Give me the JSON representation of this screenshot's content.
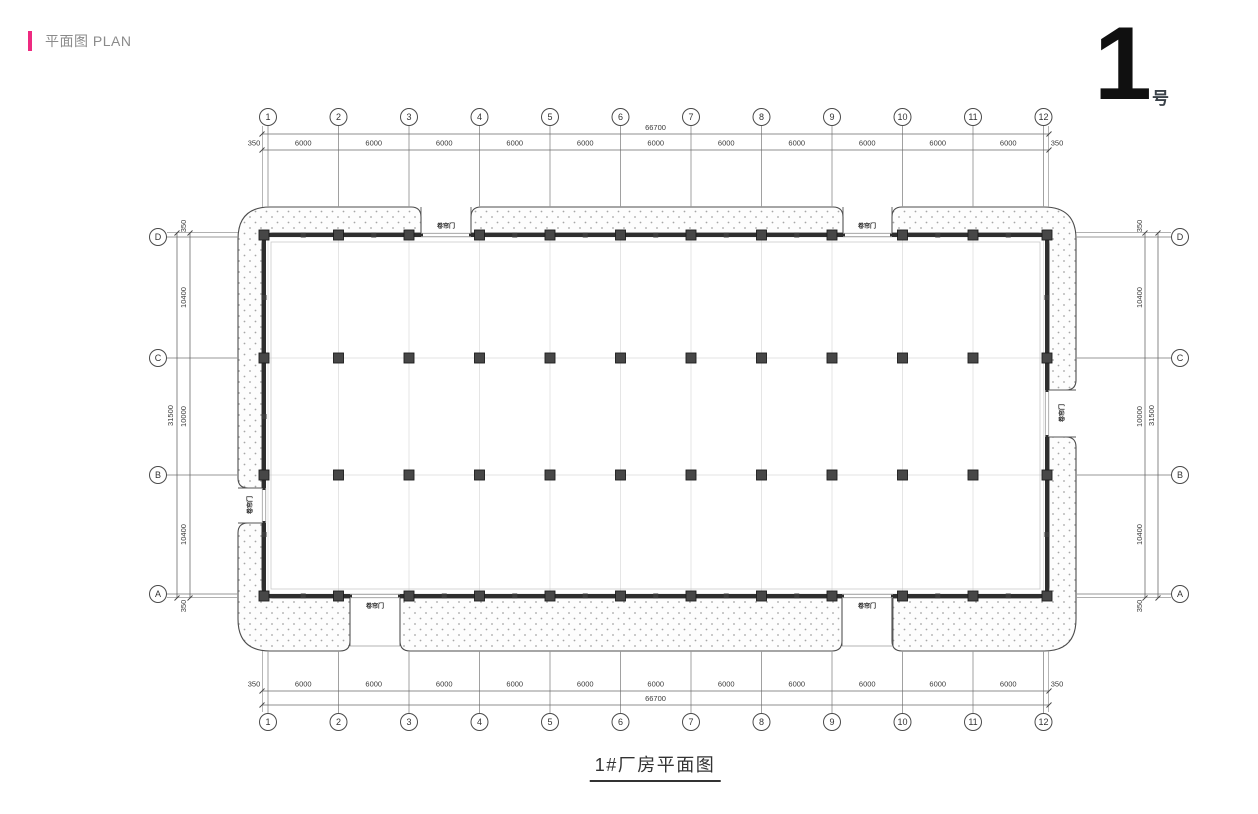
{
  "header": {
    "title": "平面图 PLAN",
    "accent_color": "#ee2a80"
  },
  "sheet_badge": {
    "number": "1",
    "suffix": "号"
  },
  "drawing": {
    "title": "1#厂房平面图",
    "axes": {
      "columns": [
        "1",
        "2",
        "3",
        "4",
        "5",
        "6",
        "7",
        "8",
        "9",
        "10",
        "11",
        "12"
      ],
      "rows_top_to_bottom": [
        "D",
        "C",
        "B",
        "A"
      ]
    },
    "dimensions": {
      "horizontal": {
        "total": "66700",
        "segments": [
          "350",
          "6000",
          "6000",
          "6000",
          "6000",
          "6000",
          "6000",
          "6000",
          "6000",
          "6000",
          "6000",
          "6000",
          "350"
        ]
      },
      "vertical": {
        "total": "31500",
        "segments": [
          "350",
          "10400",
          "10000",
          "10400",
          "350"
        ]
      }
    },
    "doors": [
      {
        "id": "top-door-1",
        "wall": "top",
        "label": "卷帘门"
      },
      {
        "id": "top-door-2",
        "wall": "top",
        "label": "卷帘门"
      },
      {
        "id": "bottom-door-1",
        "wall": "bottom",
        "label": "卷帘门"
      },
      {
        "id": "bottom-door-2",
        "wall": "bottom",
        "label": "卷帘门"
      },
      {
        "id": "left-door",
        "wall": "left",
        "label": "卷帘门"
      },
      {
        "id": "right-door",
        "wall": "right",
        "label": "卷帘门"
      }
    ],
    "colors": {
      "wall": "#2e2e2e",
      "column": "#474747",
      "line": "#3a3a3a",
      "outer_grid": "#979797",
      "faint_grid": "#e3e3e3",
      "stipple": "#a6a6a6",
      "apron_stroke": "#4d4d4d"
    }
  }
}
